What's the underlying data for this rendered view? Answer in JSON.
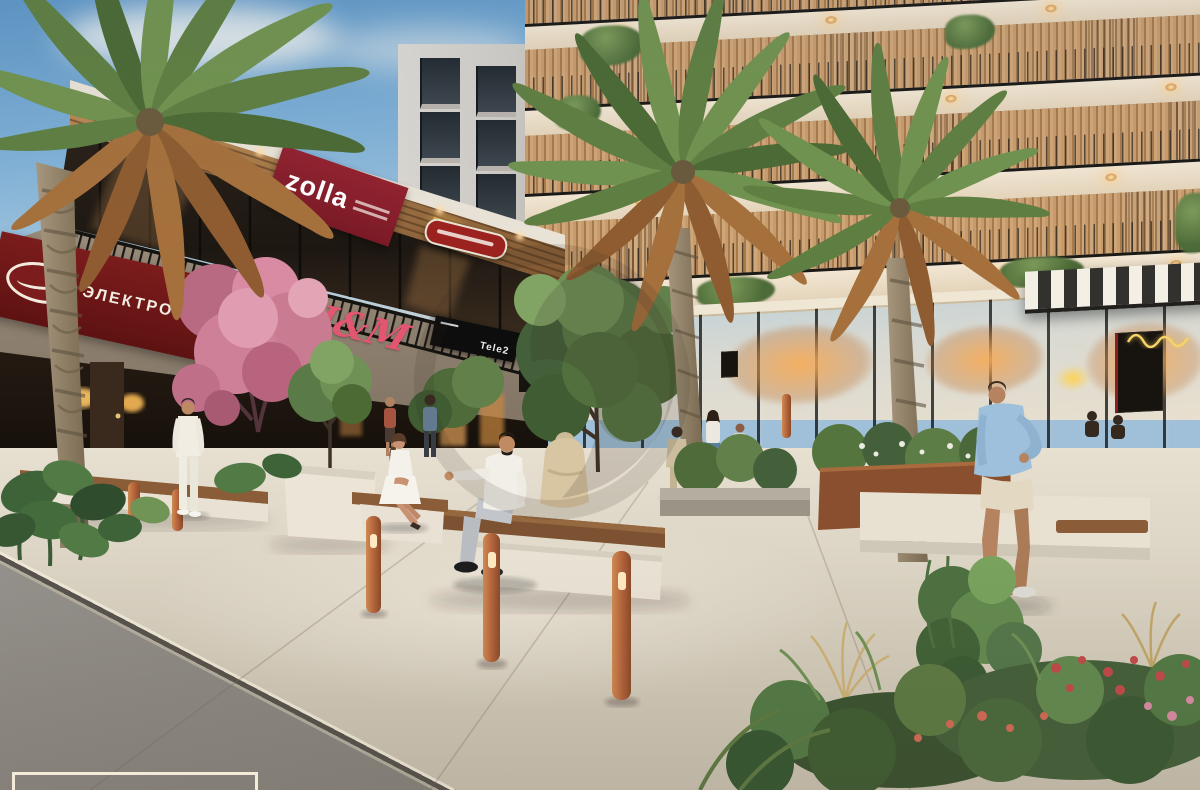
{
  "signs": {
    "electronics": {
      "label": "ЭЛЕКТРОНИКА",
      "bg": "#6f1717",
      "text_color": "#f3ece0"
    },
    "zolla": {
      "label": "zolla",
      "bg": "#8e2130",
      "text_color": "#ffffff"
    },
    "hm": {
      "label": "H&M",
      "color": "#e25672"
    },
    "tele2": {
      "label": "Tele2",
      "bg": "#0d0d0d",
      "text_color": "#e8eaec"
    }
  },
  "palette": {
    "sky": "#7fb0d6",
    "plaza_pavement": "#ddd5c5",
    "street_asphalt": "#8b8781",
    "corten_bollard": "#b5653c",
    "canopy_wood": "#a97c4b",
    "facade_cream": "#efe3cd",
    "louver_wood": "#c0956a",
    "foliage_green": "#5e7d44",
    "blossom_pink": "#cf8099",
    "wave_overlay": "#f2e6d2"
  }
}
